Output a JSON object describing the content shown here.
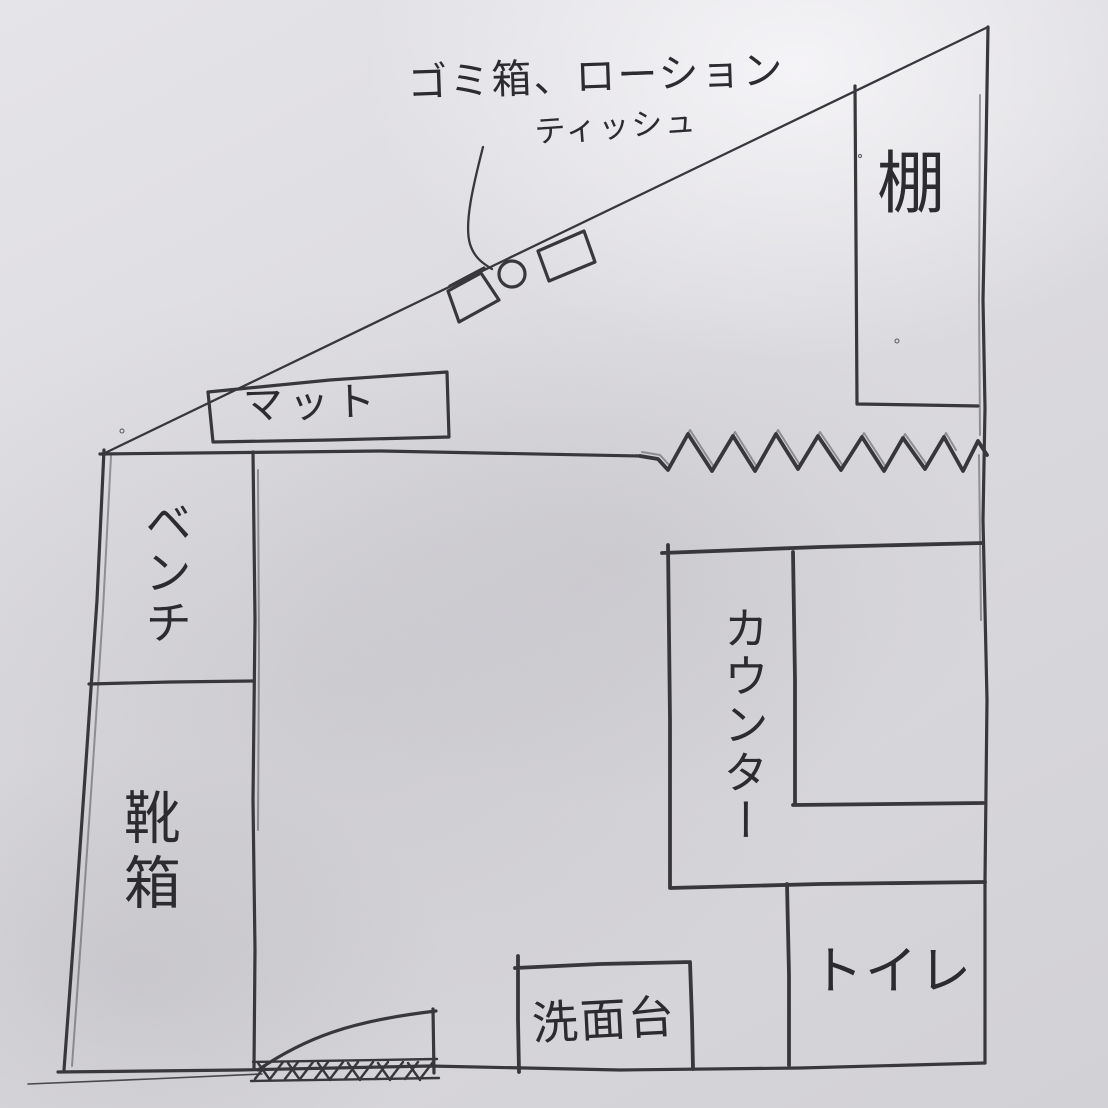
{
  "sketch_type": "hand-drawn floor plan",
  "colors": {
    "paper": "#dbdade",
    "ink": "#38373b",
    "text_ink": "#2c2b2f"
  },
  "annotation": {
    "line1": "ゴミ箱、ローション",
    "line2": "ティッシュ"
  },
  "areas": {
    "shelf": "棚",
    "mat": "マット",
    "bench": "ベンチ",
    "shoe_box": "靴箱",
    "counter": "カウンター",
    "toilet": "トイレ",
    "washbasin": "洗面台"
  }
}
